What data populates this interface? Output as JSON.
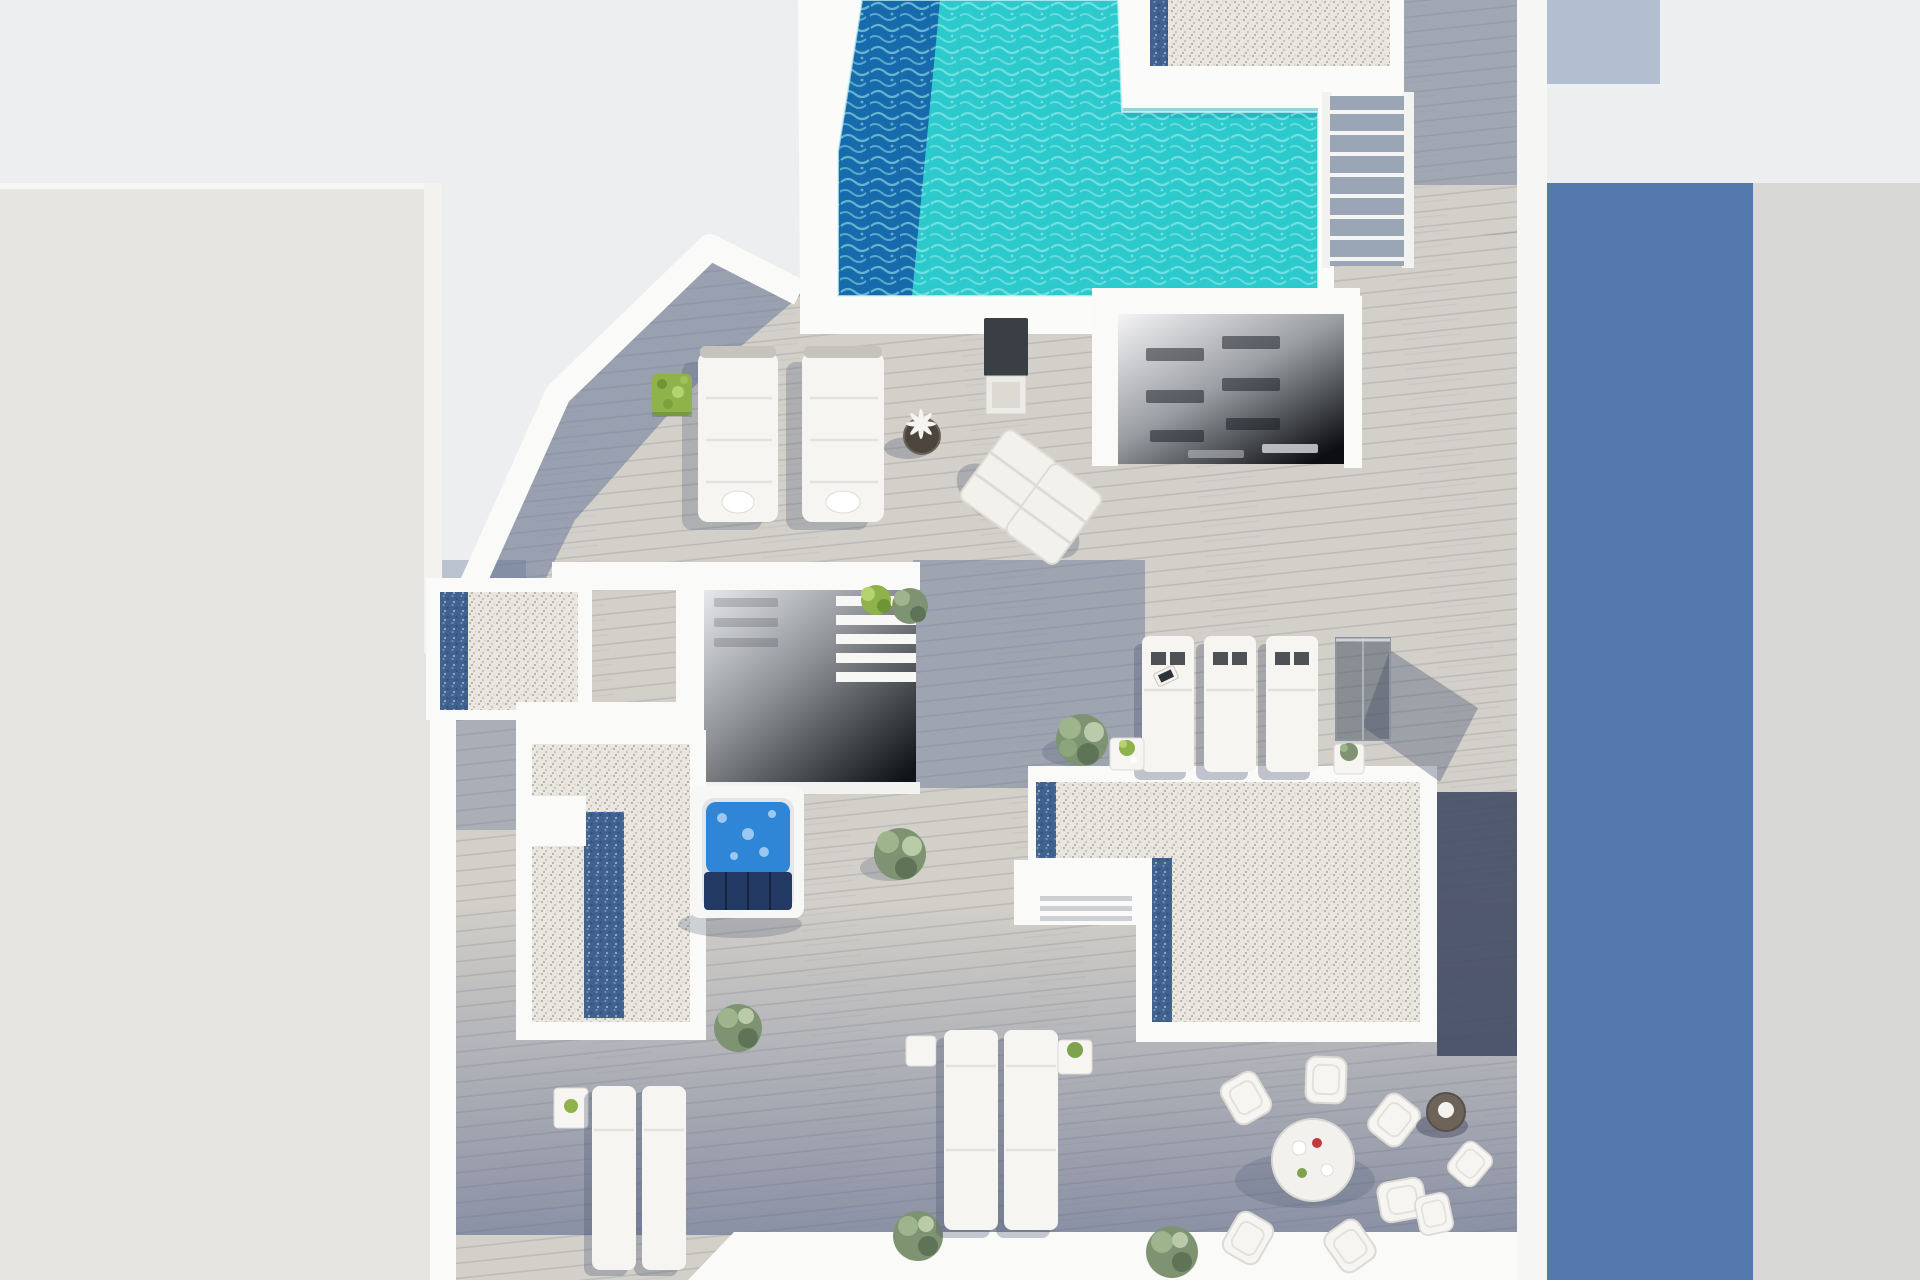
{
  "scene": {
    "type": "3d-architectural-render",
    "view": "top-down-axonometric",
    "subject": "penthouse rooftop terrace floor plan with swimming pool",
    "objects": [
      "swimming-pool",
      "pool-stairs",
      "roof-gravel-band",
      "stairwell-upper",
      "stairwell-middle",
      "gravel-roof-left",
      "gravel-roof-center",
      "jacuzzi",
      "double-sun-loungers",
      "beach-chairs",
      "lounger-trio",
      "glass-screen",
      "dining-set",
      "bistro-set",
      "planters",
      "neighbor-buildings"
    ]
  },
  "colors": {
    "background": "#edeef0",
    "neighbor_building": "#e7e5e2",
    "building_face_shadow": "#a5a19c",
    "cast_shadow_blue": "#5379ad",
    "neighbor_roof_gray": "#d8d8d6",
    "wall_white": "#fafaf9",
    "deck_sunlit": "#d3d0c9",
    "deck_shadow": "#5f6f95",
    "deck_dark": "#454e66",
    "pool_water": "#2cc9cd",
    "pool_deep": "#1567aa",
    "pool_ripple": "#aef3f0",
    "jacuzzi_water": "#2f86d6",
    "jacuzzi_cover": "#223a63",
    "gravel": "#eae7e1",
    "gravel_blue": "#41618f",
    "stair_wood": "#9aa5b6",
    "furniture_white": "#f6f5f2",
    "plant_bright": "#8fb24a",
    "plant_soft": "#7e9371",
    "accent_red": "#c0393b"
  }
}
